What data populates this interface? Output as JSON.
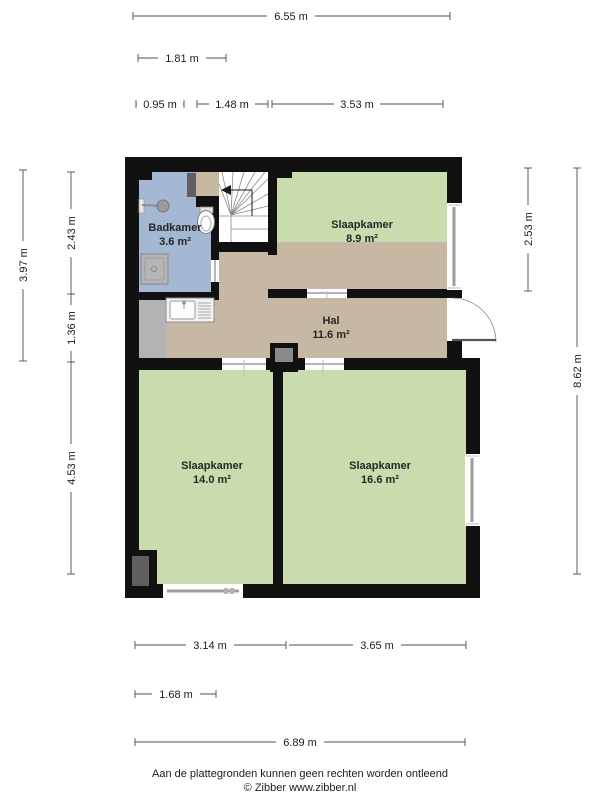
{
  "floor_plan": {
    "rooms": [
      {
        "name": "Badkamer",
        "area": "3.6 m²"
      },
      {
        "name": "Slaapkamer",
        "area": "8.9 m²"
      },
      {
        "name": "Hal",
        "area": "11.6 m²"
      },
      {
        "name": "Slaapkamer",
        "area": "14.0 m²"
      },
      {
        "name": "Slaapkamer",
        "area": "16.6 m²"
      }
    ],
    "colors": {
      "wall": "#111111",
      "bedroom": "#c9dcae",
      "hall": "#c7b8a3",
      "bathroom": "#a4b8d4",
      "stairs": "#ffffff",
      "entry_gray": "#b3b3b3",
      "shaft_gray": "#5f5f5f",
      "chimney_gray": "#8a8a8a"
    }
  },
  "dimensions": {
    "top": [
      "6.55 m",
      "1.81 m",
      "0.95 m",
      "1.48 m",
      "3.53 m"
    ],
    "left": [
      "3.97 m",
      "2.43 m",
      "1.36 m",
      "4.53 m"
    ],
    "right": [
      "2.53 m",
      "8.62 m"
    ],
    "bottom": [
      "3.14 m",
      "3.65 m",
      "1.68 m",
      "6.89 m"
    ]
  },
  "footer": {
    "disclaimer": "Aan de plattegronden kunnen geen rechten worden ontleend",
    "credit": "© Zibber www.zibber.nl"
  }
}
